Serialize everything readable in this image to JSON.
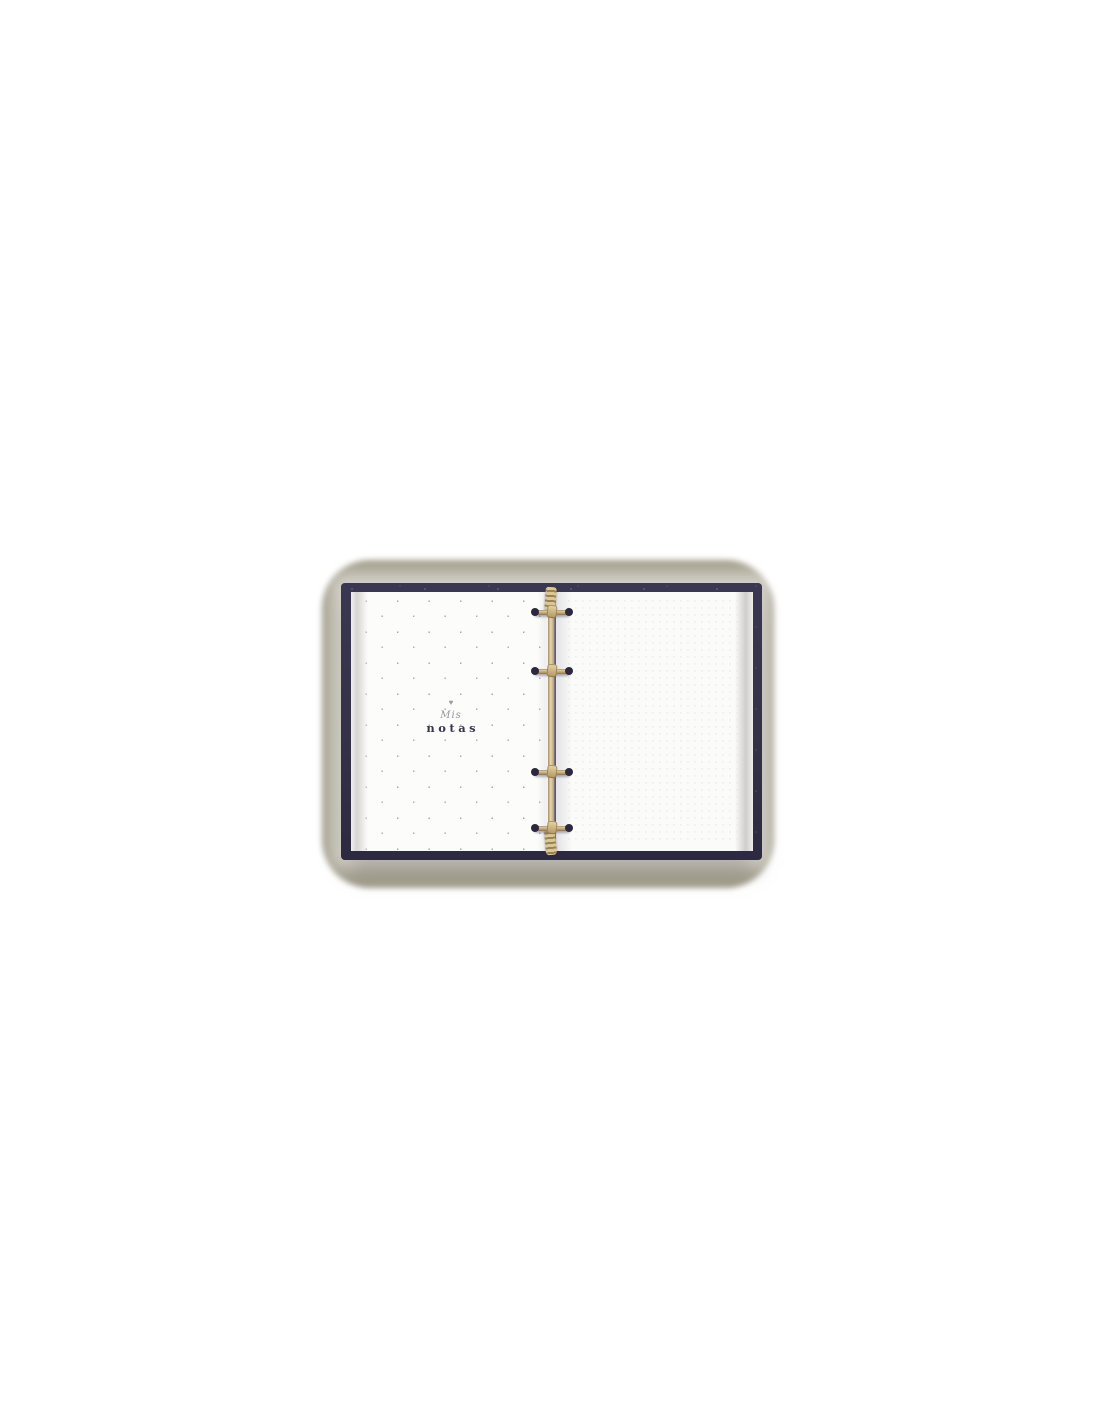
{
  "left_page": {
    "heart_icon": "♥",
    "title_line1": "Mis",
    "title_line2": "notas",
    "dot_pattern": "sparse-diagonal"
  },
  "right_page": {
    "dot_pattern": "dense-grid"
  },
  "binder": {
    "ring_count": 4,
    "ring_style": "gold with dark tips"
  },
  "colors": {
    "cover_navy": "#343148",
    "cover_speckle": "#8b85a8",
    "ring_gold": "#c3a875",
    "ring_tip": "#2c2840",
    "mat_taupe": "#a49f8d",
    "page_white": "#fcfcfb",
    "left_page_dot": "#a8a8b0",
    "right_page_dot": "#dcdcda",
    "title_text": "#3a364f",
    "subtitle_text": "#96949f"
  }
}
